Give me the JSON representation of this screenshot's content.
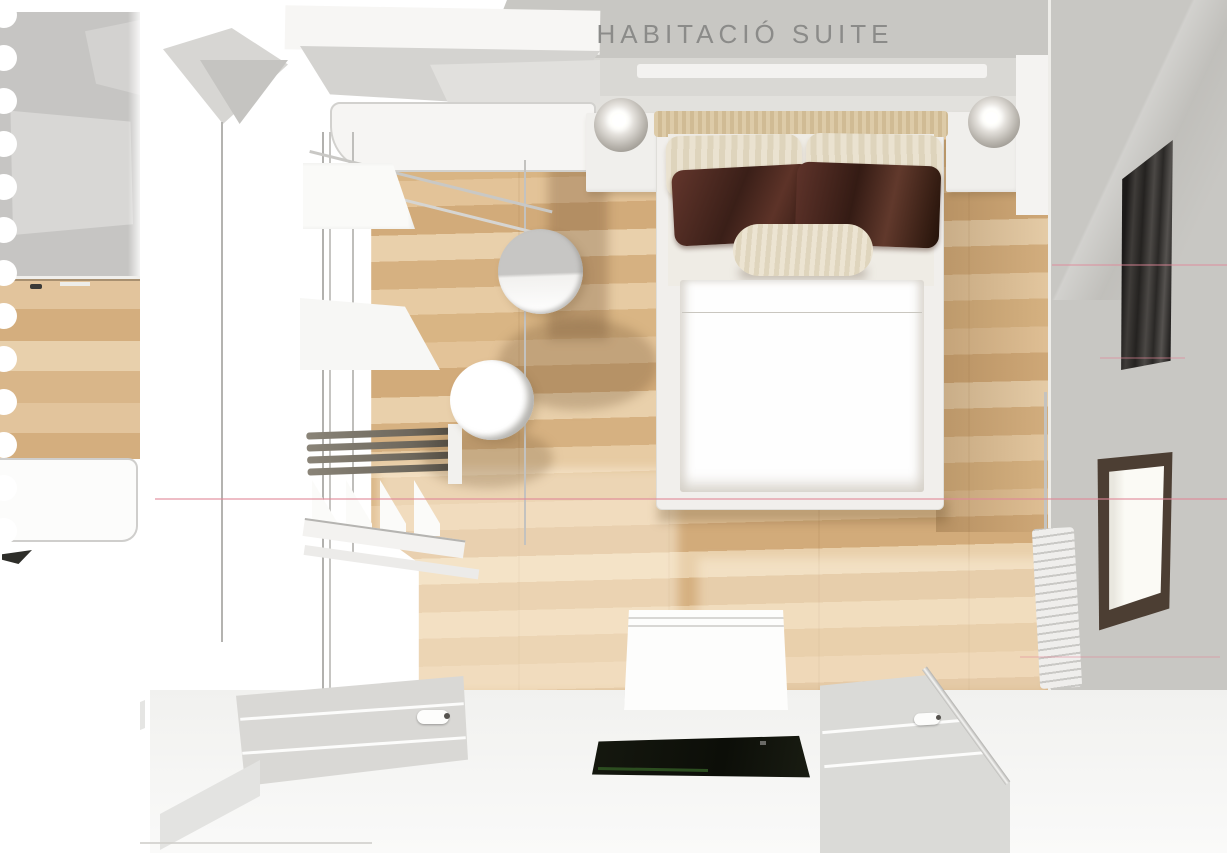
{
  "header": {
    "title": "HABITACIÓ SUITE"
  },
  "scene": {
    "view": "top-down interior render",
    "objects": [
      "double-bed",
      "tan-headboard",
      "cream-striped-pillows",
      "dark-maroon-pillows",
      "bolster-cushion",
      "white-duvet",
      "left-nightstand",
      "right-nightstand",
      "globe-lamp-left",
      "globe-lamp-right",
      "wall-ledge-shelf",
      "open-wardrobe",
      "corner-cabinet",
      "hanging-rails",
      "shelf-dividers",
      "round-stool-upper",
      "round-stool-lower",
      "foot-bench",
      "dark-rug",
      "sliding-door-left",
      "sliding-door-right",
      "door-rail",
      "dark-window-panel",
      "bright-window",
      "radiator",
      "oak-parquet-floor",
      "notebook-punched-holes",
      "pink-scan-lines"
    ]
  },
  "palette": {
    "wall-gray": "#c8c7c3",
    "wall-light": "#d9d8d4",
    "strip-gray": "#c6c5c3",
    "title-color": "#8b8b89",
    "wood-a": "#e7cba3",
    "wood-b": "#d9b584",
    "wood-c": "#e3c398",
    "wood-d": "#d2ab7a",
    "scan-pink": "#e08798",
    "bed-frame": "#f1efec",
    "duvet": "#fefefe",
    "headboard": "#d7c5a2",
    "pillow-cream": "#e9e1cf",
    "pillow-dark-1": "#5e332a",
    "pillow-dark-2": "#2f1913",
    "window-dark": "#242220",
    "window-frame": "#4c3e33",
    "glass": "#fbfaf5",
    "rug-dark": "#13160d",
    "rug-green": "#2c4d20",
    "furniture-white": "#f5f4f2",
    "edge-gray": "#b7b6b3",
    "door-gray": "#d9d8d5"
  }
}
